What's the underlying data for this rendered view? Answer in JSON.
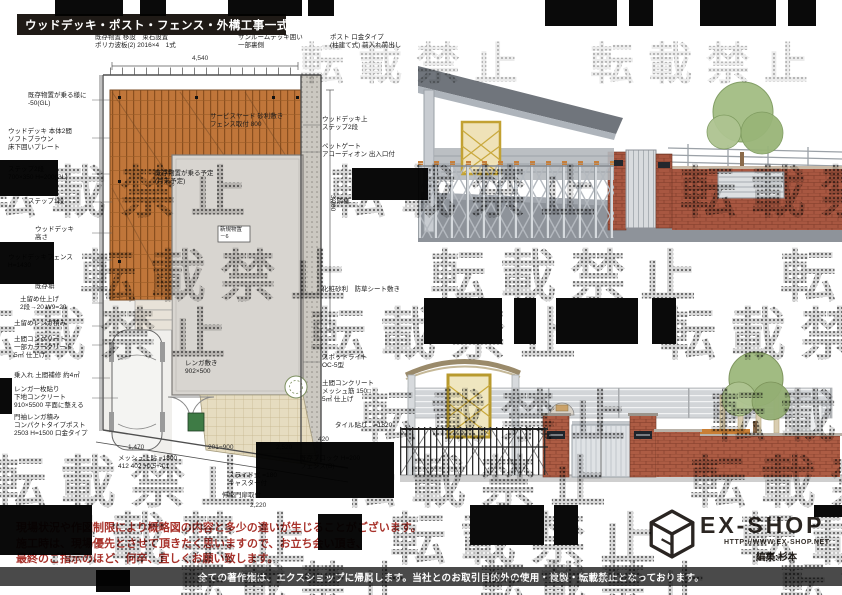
{
  "header": {
    "title": "ウッドデッキ・ポスト・フェンス・外構工事一式"
  },
  "watermark": {
    "text": "転載禁止",
    "row_text": "転載禁止　転載禁止　転載禁止"
  },
  "plan": {
    "top_labels": [
      {
        "text": "既存物置 移設　束石設置\nポリカ波板(2) 2016×4　1式"
      },
      {
        "text": "サンルームデッキ囲い\n一部裏側"
      },
      {
        "text": "ポスト 口金タイプ\n(柱建て式) 前入れ前出し"
      }
    ],
    "left_labels": [
      {
        "text": "既存物置が乗る様に\n-50(GL)"
      },
      {
        "text": "ウッドデッキ 本体2間\nソフトブラウン\n床下囲いプレート"
      },
      {
        "text": "ステップ2段\n700×350 H=200(GL)"
      },
      {
        "text": "ステップ1段"
      },
      {
        "text": "ウッドデッキ\n高さ"
      },
      {
        "text": "ウッドデッキフェンス\nH=1430"
      },
      {
        "text": "既存塀"
      },
      {
        "text": "土留め仕上げ\n2段→20 W9=20"
      },
      {
        "text": "土留めレンガ積み"
      },
      {
        "text": "土間コンクリート\n一部カラークリート\n5㎡ 仕上げ"
      },
      {
        "text": "乗入れ 土間補修 約4㎡"
      },
      {
        "text": "レンガ一枚貼り\n下地コンクリート\n910×5500 平面に整える"
      },
      {
        "text": "門袖レンガ積み\nコンパクトタイプポスト\n2503 H=1500 口金タイプ"
      }
    ],
    "right_labels": [
      {
        "text": "ウッドデッキ上\nステップ2段"
      },
      {
        "text": "ペットゲート\nアコーディオン 出入口付"
      },
      {
        "text": "お隣様"
      },
      {
        "text": "化粧砂利　防草シート敷き"
      },
      {
        "text": "スポットライト\nOC-5型"
      },
      {
        "text": "土間コンクリート\nメッシュ筋 150□\n5㎡ 仕上げ"
      },
      {
        "text": "タイル貼り　=1820"
      }
    ],
    "inner_labels": [
      {
        "text": "サービスヤード 砂利敷き\nフェンス取付 800"
      },
      {
        "text": "既存物置が乗る予定\n(月末予定)"
      },
      {
        "text": "新規物置\n－6"
      },
      {
        "text": "レンガ敷き\n902×500"
      }
    ],
    "bottom_labels": [
      {
        "text": "1,470"
      },
      {
        "text": "201=900"
      },
      {
        "text": "2,520"
      },
      {
        "text": "420"
      },
      {
        "text": "メッシュ上貼 =1800\n412 402 +0.5+4.1"
      },
      {
        "text": "既存ブロック H=200\nフェンス(B)"
      },
      {
        "text": "スライド式 =180\nキャスター付"
      },
      {
        "text": "伸縮門扉取付"
      },
      {
        "text": "2,220"
      }
    ],
    "dims": {
      "top": "4,540",
      "right": "3,700"
    }
  },
  "disclaimer": {
    "lines": [
      "現場状況や作図制限により概略図の内容と多少の違いが生じることがございます。",
      "施工時は、現場優先とさせて頂きたく思いますので、お立ち会い頂き、",
      "最終のご指示のほど、何卒、宜しくお願い致します。"
    ]
  },
  "logo": {
    "name": "EX-SHOP",
    "url": "HTTP://WWW.EX-SHOP.NET",
    "credit": "編集:杉本"
  },
  "footer": {
    "text": "全ての著作権は、エクスショップに帰属します。当社とのお取引目的外の使用・複製・転載禁止となっております。"
  }
}
